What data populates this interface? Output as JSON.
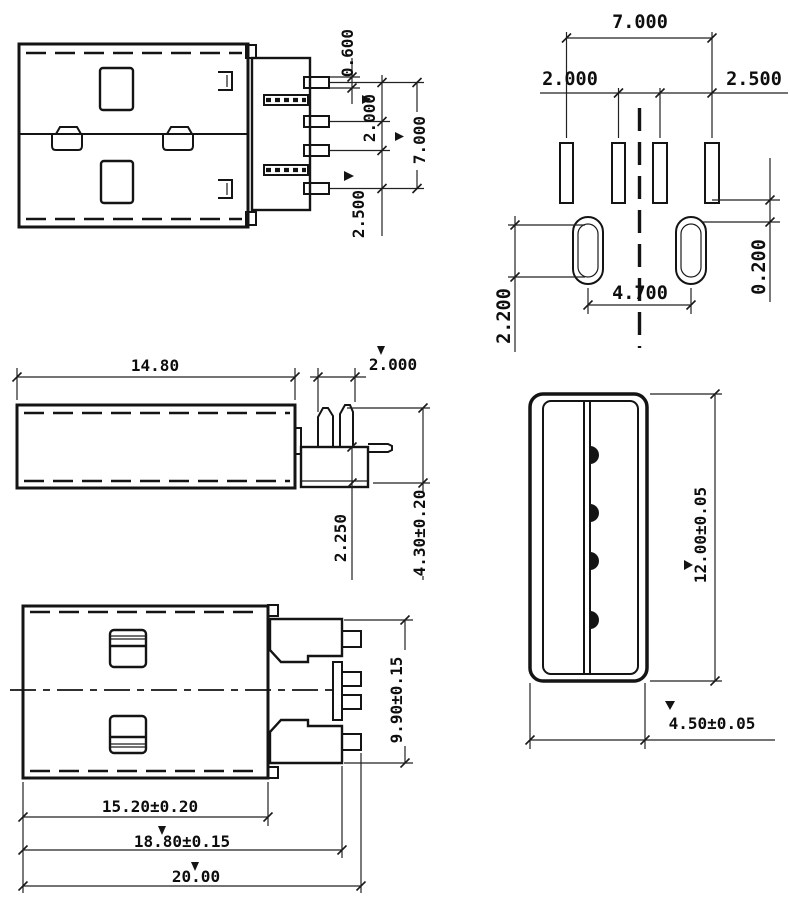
{
  "drawing": {
    "title": "USB A type plug connector dimensional drawing",
    "units": "mm",
    "line_color": "#141414",
    "background_color": "#ffffff"
  },
  "views": {
    "side_section": {
      "label": "side view with contact pins",
      "dims": {
        "contact_thickness": "0.600",
        "contact_pitch_inner": "2.000",
        "contact_span": "7.000",
        "contact_pitch_outer": "2.500"
      }
    },
    "pcb_footprint": {
      "label": "PCB footprint",
      "dims": {
        "pad_span": "7.000",
        "pad_pitch_inner": "2.000",
        "pad_pitch_outer": "2.500",
        "hole_offset": "0.200",
        "hole_span": "4.700",
        "hole_length": "2.200"
      }
    },
    "side_profile": {
      "label": "side profile",
      "dims": {
        "shell_length": "14.80",
        "leg_pitch": "2.000",
        "leg_length": "2.250",
        "mount_height": "4.30±0.20"
      }
    },
    "top_view": {
      "label": "top view",
      "dims": {
        "body_width": "9.90±0.15",
        "shell_length": "15.20±0.20",
        "length_to_pads": "18.80±0.15",
        "overall_length": "20.00"
      }
    },
    "front_face": {
      "label": "mating face",
      "dims": {
        "face_width": "12.00±0.05",
        "face_height": "4.50±0.05"
      }
    }
  }
}
